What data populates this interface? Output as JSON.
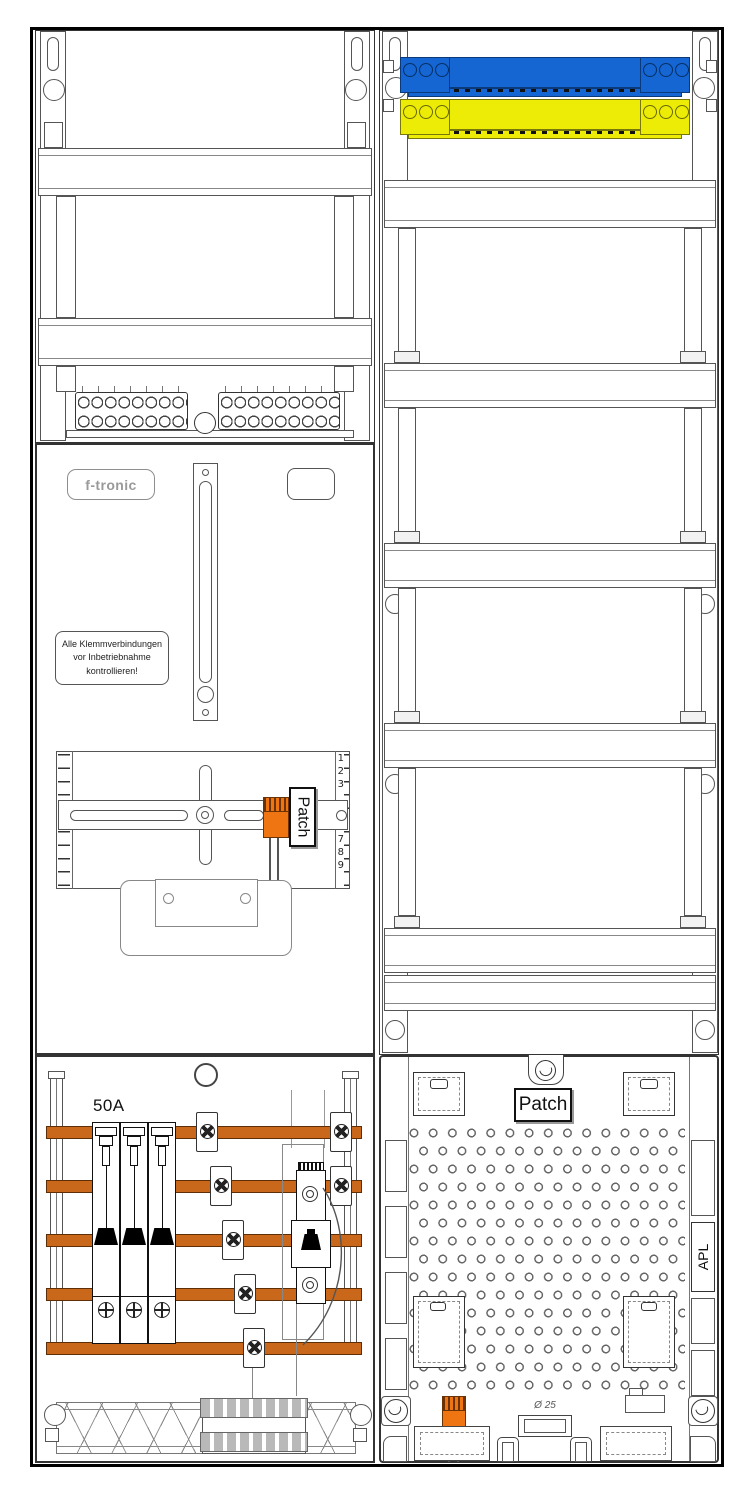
{
  "colors": {
    "busbar_orange": "#c9671a",
    "device_orange": "#ee7512",
    "neutral_blue": "#1565d2",
    "pe_yellow": "#ecec06"
  },
  "left_column": {
    "meter_panel": {
      "brand_logo": "f-tronic",
      "warning_label": "Alle Klemmverbindungen\nvor Inbetriebnahme\nkontrollieren!",
      "patch_device_label": "Patch",
      "ruler_numbers_upper": [
        "1",
        "2",
        "3"
      ],
      "ruler_numbers_lower": [
        "7",
        "8",
        "9"
      ]
    },
    "connection_area": {
      "main_breaker_rating": "50A"
    }
  },
  "right_column": {
    "bottom_panel": {
      "patch_label": "Patch",
      "apl_label": "APL",
      "knockout_diameter_label": "Ø 25"
    }
  }
}
